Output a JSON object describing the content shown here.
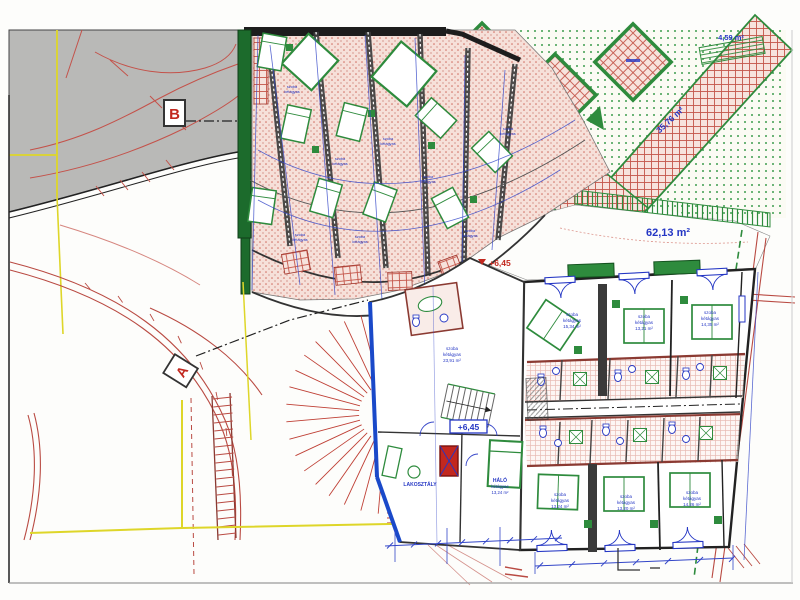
{
  "markers": {
    "a": "A",
    "b": "B"
  },
  "elevations": {
    "upper": "+6,45",
    "lower": "+6,45"
  },
  "area_labels": {
    "path_small": "4,59 m²",
    "path_large": "35,76 m²",
    "terrace": "62,13 m²"
  },
  "rooms": {
    "suite": {
      "name": "LAKOSZTÁLY"
    },
    "halo": {
      "name": "HÁLÓ",
      "type": "kétágyas",
      "area": "13,24 m²"
    },
    "center": {
      "name": "szoba",
      "type": "kétágyas",
      "area": "23,91 m²"
    },
    "wing_upper": [
      {
        "name": "szoba",
        "type": "kétágyas",
        "area": "15,34 m²"
      },
      {
        "name": "szoba",
        "type": "kétágyas",
        "area": "13,21 m²"
      },
      {
        "name": "szoba",
        "type": "kétágyas",
        "area": "14,35 m²"
      }
    ],
    "wing_lower": [
      {
        "name": "szoba",
        "type": "kétágyas",
        "area": "13,24 m²"
      },
      {
        "name": "szoba",
        "type": "kétágyas",
        "area": "13,20 m²"
      },
      {
        "name": "szoba",
        "type": "kétágyas",
        "area": "14,26 m²"
      }
    ],
    "fan": {
      "name": "szoba",
      "type": "kétágyas"
    }
  },
  "colors": {
    "red": "#c0392b",
    "blue": "#2436c4",
    "green": "#2e8b3d",
    "dark_green": "#1c6b2c",
    "yellow": "#ded629",
    "gray": "#b9b9b7"
  }
}
